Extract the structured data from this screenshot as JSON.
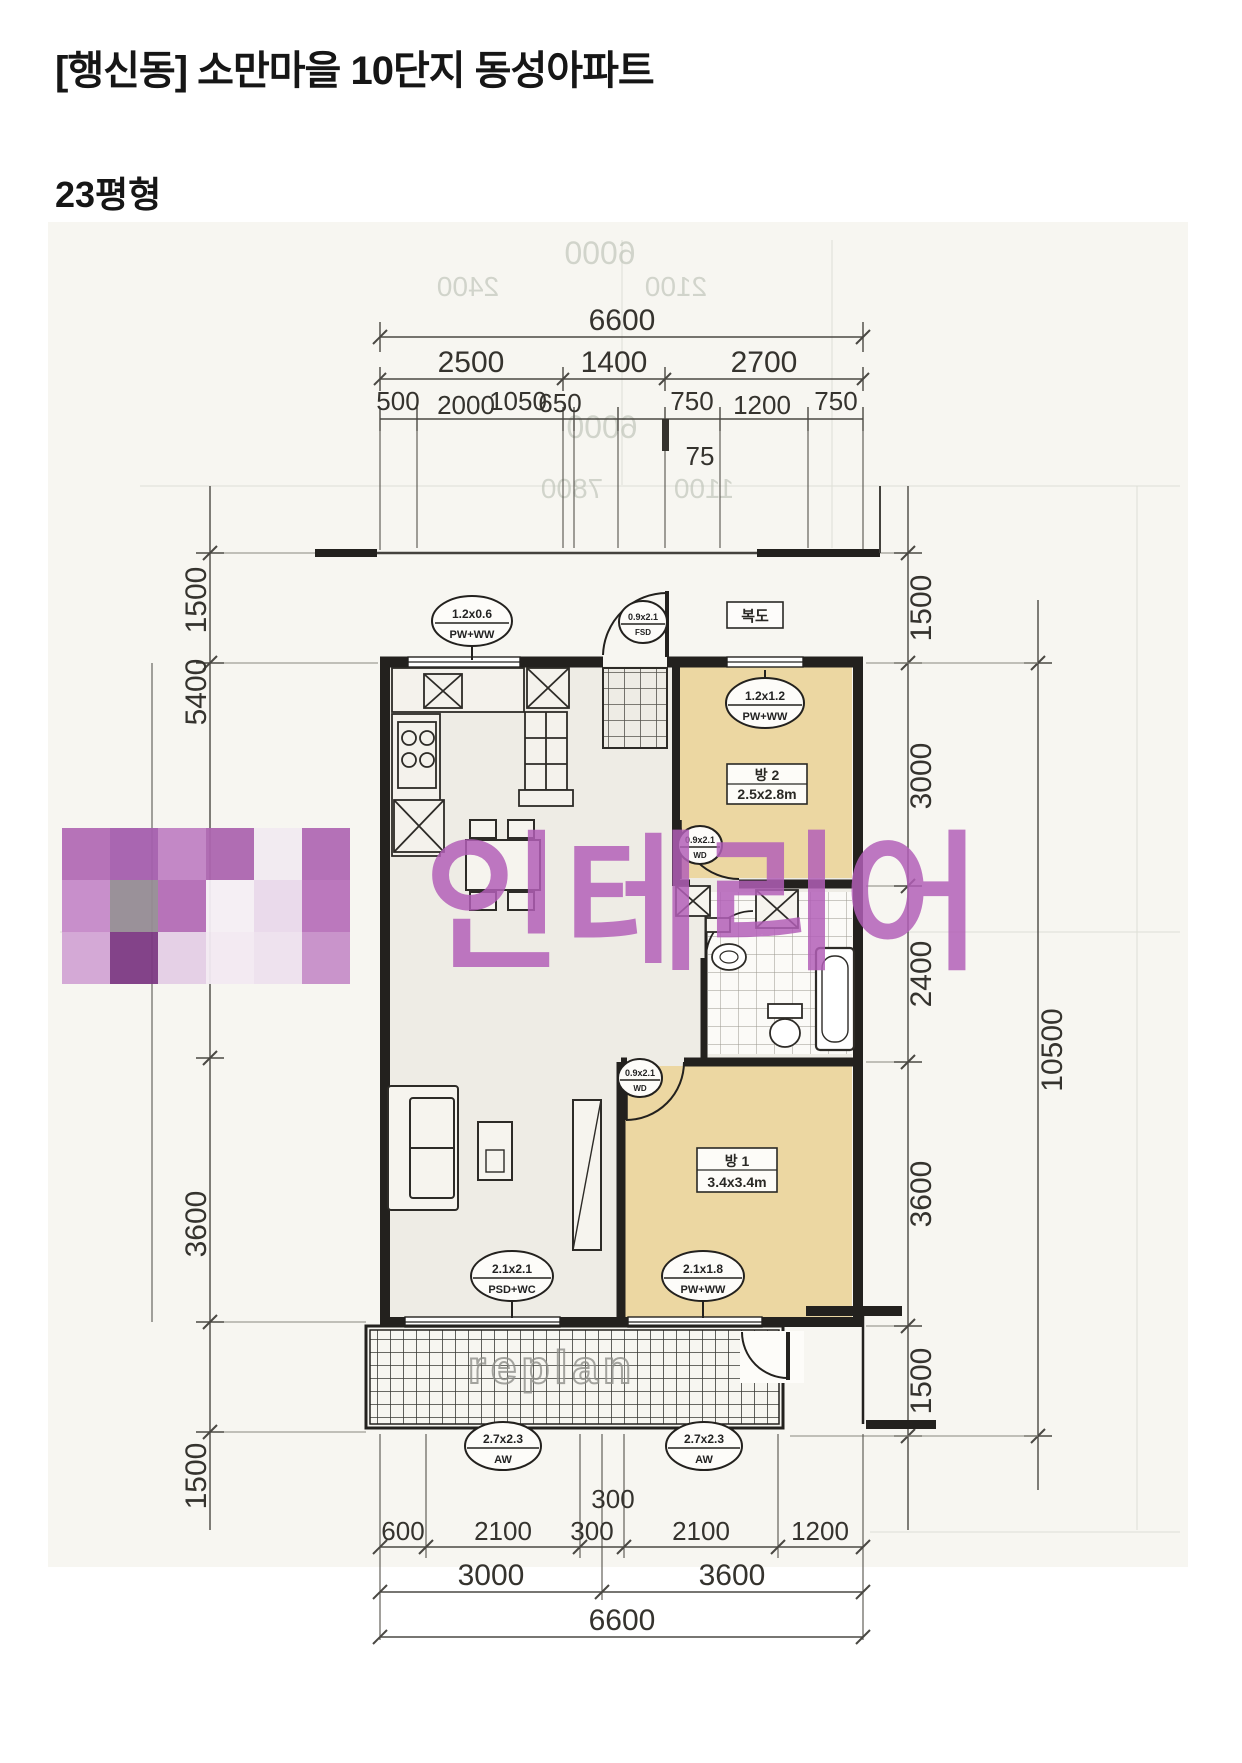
{
  "page": {
    "title": "[행신동] 소만마을 10단지 동성아파트",
    "subtitle": "23평형"
  },
  "floor_plan": {
    "rooms": {
      "corridor_label": "복도",
      "room1": {
        "name": "방 1",
        "size": "3.4x3.4m"
      },
      "room2": {
        "name": "방 2",
        "size": "2.5x2.8m"
      }
    },
    "openings": {
      "kitchen_window": {
        "size": "1.2x0.6",
        "type": "PW+WW"
      },
      "entry_door": {
        "size": "0.9x2.1",
        "type": "FSD"
      },
      "room2_window": {
        "size": "1.2x1.2",
        "type": "PW+WW"
      },
      "room2_door": {
        "size": "0.9x2.1",
        "type": "WD"
      },
      "room1_door": {
        "size": "0.9x2.1",
        "type": "WD"
      },
      "living_window": {
        "size": "2.1x2.1",
        "type": "PSD+WC"
      },
      "room1_window": {
        "size": "2.1x1.8",
        "type": "PW+WW"
      },
      "balcony_window_left": {
        "size": "2.7x2.3",
        "type": "AW"
      },
      "balcony_window_right": {
        "size": "2.7x2.3",
        "type": "AW"
      }
    },
    "dimensions": {
      "top": {
        "total": "6600",
        "row2": [
          "2500",
          "1400",
          "2700"
        ],
        "row3": [
          "500",
          "2000",
          "1050",
          "650",
          "750",
          "1200",
          "750"
        ],
        "sub": "75"
      },
      "bottom": {
        "row1": [
          "600",
          "2100",
          "300",
          "300",
          "2100",
          "1200"
        ],
        "row2": [
          "3000",
          "3600"
        ],
        "total": "6600"
      },
      "left": [
        "1500",
        "5400",
        "3600",
        "1500"
      ],
      "right": [
        "1500",
        "3000",
        "2400",
        "3600",
        "1500"
      ],
      "right_total": "10500"
    },
    "ghost_labels": [
      "6000",
      "2400",
      "2100",
      "6000",
      "7800",
      "1100"
    ],
    "watermark": {
      "text": "인테리어",
      "replan": "replan",
      "color": "#b35fb8",
      "mosaic": [
        [
          "#b36cb5",
          "#a55fae",
          "#c183c4",
          "#ad66b0",
          "#f2ebf2",
          "#b16ab4"
        ],
        [
          "#c68ac9",
          "#968c95",
          "#b46db7",
          "#f5eff5",
          "#ead9eb",
          "#b872bb"
        ],
        [
          "#d3a5d5",
          "#7d3a84",
          "#e5cfe6",
          "#f3eaf3",
          "#eee1ee",
          "#c78fc9"
        ]
      ]
    }
  }
}
